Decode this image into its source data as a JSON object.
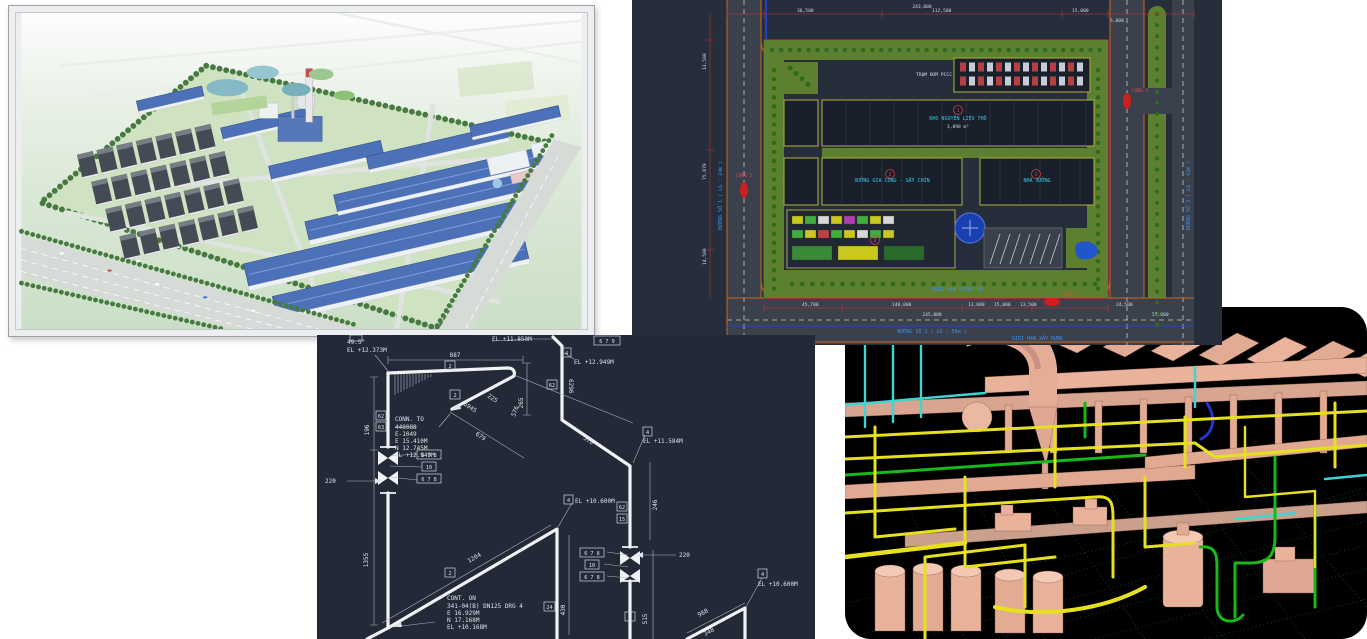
{
  "panels": {
    "render": {
      "colors": {
        "roof_blue": "#4d71b8",
        "warehouse_dark": "#454b54",
        "field": "#cfe2c2",
        "tree": "#477a40",
        "chimney_red": "#c14f4f",
        "frame": "#eceef0"
      }
    },
    "site_plan": {
      "colors": {
        "bg": "#272e3b",
        "road": "#3a414d",
        "green": "#5c8030",
        "boundary_red": "#e03030",
        "edge_orange": "#c9681c",
        "blue_line": "#2244ee"
      },
      "labels": {
        "pccc": "TRẠM BƠM PCCC",
        "bldg1": "KHO NGUYÊN LIỆU THÔ",
        "bldg1_area": "3,898 m²",
        "bldg2": "XƯỞNG GIA CÔNG - SẤY CHÍN",
        "bldg3": "NHÀ XƯỞNG",
        "road_bottom": "ĐƯỜNG SỐ 2 ( LG : 56m )",
        "road_left": "ĐƯỜNG SỐ 1 ( LG : 24m )",
        "road_right": "ĐƯỜNG SỐ 3 ( LG : 42m )",
        "gate1": "CỔNG 1",
        "gate2": "CỔNG 2",
        "gate3": "CỔNG 3",
        "note_blue1": "GIỚI HẠN XÂY DỰNG",
        "note_blue2": "GIỚI HẠN ĐƯỜNG ĐỎ",
        "dim_total_top": "243,000",
        "dims_top": [
          "36,500",
          "112,500",
          "15,000",
          "5,000"
        ],
        "dims_left": [
          "13,500",
          "75,870",
          "14,500"
        ],
        "dims_bottom": [
          "45,700",
          "148,000",
          "13,000",
          "15,000",
          "13,500",
          "24,500",
          "57,000"
        ],
        "dim_total_bottom": "245,000",
        "plot_nums": [
          "1",
          "2",
          "3",
          "4"
        ]
      }
    },
    "iso": {
      "colors": {
        "bg": "#232937",
        "line": "#f0f2f4"
      },
      "labels": {
        "angle": "49.5°",
        "el_12373": "EL +12.373M",
        "el_11850": "EL +11.850M",
        "el_12949": "EL +12.949M",
        "el_11584": "EL +11.584M",
        "el_10600": "EL +10.600M",
        "box_679": "6 7 9",
        "box_678": "6 7 8",
        "tag_2": "2",
        "tag_4": "4",
        "tag_10": "10",
        "tag_15": "15",
        "tag_24": "24",
        "tag_62": "62",
        "tag_63": "63",
        "d887": "887",
        "d196": "196",
        "d220": "220",
        "d225": "225",
        "d246": "246",
        "d265": "265",
        "d348": "348",
        "d378": "378",
        "d430": "430",
        "d515": "515",
        "d576": "576",
        "d679": "679",
        "d968": "968",
        "d1204": "1204",
        "d1355": "1355",
        "d6296": "6296",
        "d6945": "6945",
        "conn_block": [
          "CONN. TO",
          "448088",
          "E-1049",
          "E 15.410M",
          "N 12.745M",
          "EL +12.949M"
        ],
        "cont_block": [
          "CONT. ON",
          "341-04(B) DN125 DRG 4",
          "E 16.929M",
          "N 17.168M",
          "EL +10.168M"
        ]
      }
    },
    "model3d": {
      "colors": {
        "bg": "#000000",
        "equipment": "#eab39b",
        "pipe_yellow": "#e6e01f",
        "pipe_green": "#18b818",
        "pipe_cyan": "#3fd4d4",
        "pipe_blue": "#2233cc",
        "grid": "#1d4a1d"
      }
    }
  }
}
